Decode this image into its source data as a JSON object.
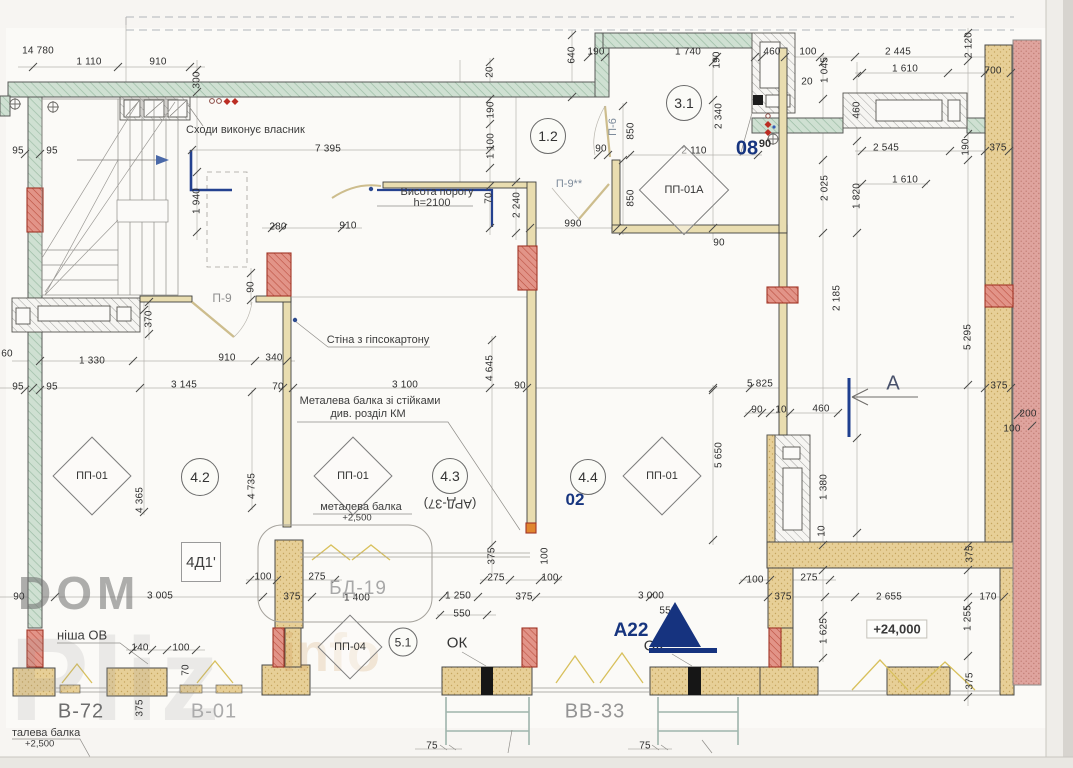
{
  "watermark": {
    "l1": "DOM",
    "l2": "Pliz",
    "l3": "info"
  },
  "rooms": [
    {
      "n": "1.2",
      "x": 548,
      "y": 136,
      "d": 34
    },
    {
      "n": "3.1",
      "x": 684,
      "y": 103,
      "d": 34
    },
    {
      "n": "4.2",
      "x": 200,
      "y": 477,
      "d": 36
    },
    {
      "n": "4.3",
      "x": 450,
      "y": 476,
      "d": 34
    },
    {
      "n": "4.4",
      "x": 588,
      "y": 477,
      "d": 34
    },
    {
      "n": "5.1",
      "x": 403,
      "y": 642,
      "d": 27
    }
  ],
  "panels": [
    {
      "n": "ПП-01",
      "x": 92,
      "y": 476,
      "s": 54
    },
    {
      "n": "ПП-01",
      "x": 353,
      "y": 476,
      "s": 54
    },
    {
      "n": "ПП-01",
      "x": 662,
      "y": 476,
      "s": 54
    },
    {
      "n": "ПП-01А",
      "x": 684,
      "y": 190,
      "s": 62
    },
    {
      "n": "ПП-04",
      "x": 350,
      "y": 647,
      "s": 44
    }
  ],
  "marks": {
    "m08": "08",
    "m08s": "90",
    "m02": "02",
    "a22": "А22",
    "secA": "А"
  },
  "doors": {
    "p9": "П-9",
    "p9s": "П-9**",
    "p6": "П-6"
  },
  "beams": {
    "bd19": "БД-19",
    "v72": "В-72",
    "v01": "В-01",
    "vv33": "ВВ-33",
    "ok1": "ОК",
    "ok2": "ОК",
    "ard": "(АРД-37)",
    "d41": "4Д1'",
    "lvl": "+24,000"
  },
  "annotations": {
    "stairs": "Сходи виконує власник",
    "vis1": "Висота порогу",
    "vis2": "h=2100",
    "wall": "Стіна з гіпсокартону",
    "mb1": "Металева балка зі стійками",
    "mb2": "див. розділ КМ",
    "mb3": "металева балка",
    "mb4": "+2,500",
    "tb1": "талева балка",
    "tb2": "+2,500",
    "nisha": "ніша ОВ"
  },
  "dims": [
    {
      "t": "14 780",
      "x": 38,
      "y": 51
    },
    {
      "t": "1 110",
      "x": 89,
      "y": 62
    },
    {
      "t": "910",
      "x": 158,
      "y": 62
    },
    {
      "t": "300",
      "x": 197,
      "y": 80,
      "r": 1
    },
    {
      "t": "7 395",
      "x": 328,
      "y": 149
    },
    {
      "t": "95",
      "x": 18,
      "y": 151
    },
    {
      "t": "95",
      "x": 52,
      "y": 151
    },
    {
      "t": "1 940",
      "x": 197,
      "y": 201,
      "r": 1
    },
    {
      "t": "280",
      "x": 278,
      "y": 227
    },
    {
      "t": "910",
      "x": 348,
      "y": 226
    },
    {
      "t": "90",
      "x": 251,
      "y": 287,
      "r": 1
    },
    {
      "t": "370",
      "x": 149,
      "y": 319,
      "r": 1
    },
    {
      "t": "60",
      "x": 7,
      "y": 354
    },
    {
      "t": "1 330",
      "x": 92,
      "y": 361
    },
    {
      "t": "910",
      "x": 227,
      "y": 358
    },
    {
      "t": "340",
      "x": 274,
      "y": 358
    },
    {
      "t": "95",
      "x": 18,
      "y": 387
    },
    {
      "t": "95",
      "x": 52,
      "y": 387
    },
    {
      "t": "3 145",
      "x": 184,
      "y": 385
    },
    {
      "t": "70",
      "x": 278,
      "y": 387
    },
    {
      "t": "4 365",
      "x": 140,
      "y": 500,
      "r": 1
    },
    {
      "t": "4 735",
      "x": 252,
      "y": 486,
      "r": 1
    },
    {
      "t": "3 100",
      "x": 405,
      "y": 385
    },
    {
      "t": "90",
      "x": 520,
      "y": 386
    },
    {
      "t": "4 645",
      "x": 490,
      "y": 368,
      "r": 1
    },
    {
      "t": "20",
      "x": 490,
      "y": 72,
      "r": 1
    },
    {
      "t": "190",
      "x": 491,
      "y": 110,
      "r": 1
    },
    {
      "t": "1 100",
      "x": 491,
      "y": 146,
      "r": 1
    },
    {
      "t": "70",
      "x": 489,
      "y": 198,
      "r": 1
    },
    {
      "t": "2 240",
      "x": 517,
      "y": 205,
      "r": 1
    },
    {
      "t": "640",
      "x": 572,
      "y": 55,
      "r": 1
    },
    {
      "t": "190",
      "x": 596,
      "y": 52
    },
    {
      "t": "1 740",
      "x": 688,
      "y": 52
    },
    {
      "t": "190",
      "x": 717,
      "y": 60,
      "r": 1
    },
    {
      "t": "90",
      "x": 601,
      "y": 149
    },
    {
      "t": "850",
      "x": 631,
      "y": 131,
      "r": 1
    },
    {
      "t": "850",
      "x": 631,
      "y": 198,
      "r": 1
    },
    {
      "t": "990",
      "x": 573,
      "y": 224
    },
    {
      "t": "2 110",
      "x": 694,
      "y": 151
    },
    {
      "t": "2 340",
      "x": 719,
      "y": 116,
      "r": 1
    },
    {
      "t": "90",
      "x": 719,
      "y": 243
    },
    {
      "t": "460",
      "x": 772,
      "y": 52
    },
    {
      "t": "100",
      "x": 808,
      "y": 52
    },
    {
      "t": "20",
      "x": 807,
      "y": 82
    },
    {
      "t": "1 045",
      "x": 825,
      "y": 70,
      "r": 1
    },
    {
      "t": "2 445",
      "x": 898,
      "y": 52
    },
    {
      "t": "1 610",
      "x": 905,
      "y": 69
    },
    {
      "t": "700",
      "x": 993,
      "y": 71
    },
    {
      "t": "2 120",
      "x": 969,
      "y": 45,
      "r": 1
    },
    {
      "t": "460",
      "x": 857,
      "y": 110,
      "r": 1
    },
    {
      "t": "2 545",
      "x": 886,
      "y": 148
    },
    {
      "t": "190",
      "x": 966,
      "y": 147,
      "r": 1
    },
    {
      "t": "375",
      "x": 998,
      "y": 148
    },
    {
      "t": "1 610",
      "x": 905,
      "y": 180
    },
    {
      "t": "2 025",
      "x": 825,
      "y": 188,
      "r": 1
    },
    {
      "t": "1 820",
      "x": 857,
      "y": 196,
      "r": 1
    },
    {
      "t": "2 185",
      "x": 837,
      "y": 298,
      "r": 1
    },
    {
      "t": "5 295",
      "x": 968,
      "y": 337,
      "r": 1
    },
    {
      "t": "375",
      "x": 999,
      "y": 386
    },
    {
      "t": "200",
      "x": 1028,
      "y": 414
    },
    {
      "t": "100",
      "x": 1012,
      "y": 429
    },
    {
      "t": "5 825",
      "x": 760,
      "y": 384
    },
    {
      "t": "90",
      "x": 757,
      "y": 410
    },
    {
      "t": "10",
      "x": 781,
      "y": 410
    },
    {
      "t": "460",
      "x": 821,
      "y": 409
    },
    {
      "t": "5 650",
      "x": 719,
      "y": 455,
      "r": 1
    },
    {
      "t": "1 380",
      "x": 824,
      "y": 487,
      "r": 1
    },
    {
      "t": "10",
      "x": 822,
      "y": 531,
      "r": 1
    },
    {
      "t": "375",
      "x": 970,
      "y": 554,
      "r": 1
    },
    {
      "t": "2 655",
      "x": 889,
      "y": 597
    },
    {
      "t": "170",
      "x": 988,
      "y": 597
    },
    {
      "t": "1 255",
      "x": 968,
      "y": 618,
      "r": 1
    },
    {
      "t": "1 625",
      "x": 824,
      "y": 631,
      "r": 1
    },
    {
      "t": "375",
      "x": 970,
      "y": 681,
      "r": 1
    },
    {
      "t": "90",
      "x": 19,
      "y": 597
    },
    {
      "t": "3 005",
      "x": 160,
      "y": 596
    },
    {
      "t": "100",
      "x": 263,
      "y": 577
    },
    {
      "t": "275",
      "x": 317,
      "y": 577
    },
    {
      "t": "375",
      "x": 292,
      "y": 597
    },
    {
      "t": "1 400",
      "x": 357,
      "y": 598
    },
    {
      "t": "140",
      "x": 140,
      "y": 648
    },
    {
      "t": "100",
      "x": 181,
      "y": 648
    },
    {
      "t": "70",
      "x": 186,
      "y": 670,
      "r": 1
    },
    {
      "t": "375",
      "x": 140,
      "y": 708,
      "r": 1
    },
    {
      "t": "1 250",
      "x": 458,
      "y": 596
    },
    {
      "t": "550",
      "x": 462,
      "y": 614
    },
    {
      "t": "375",
      "x": 492,
      "y": 556,
      "r": 1
    },
    {
      "t": "275",
      "x": 496,
      "y": 578
    },
    {
      "t": "100",
      "x": 545,
      "y": 556,
      "r": 1
    },
    {
      "t": "100",
      "x": 550,
      "y": 578
    },
    {
      "t": "375",
      "x": 524,
      "y": 597
    },
    {
      "t": "3 000",
      "x": 651,
      "y": 596
    },
    {
      "t": "550",
      "x": 668,
      "y": 611
    },
    {
      "t": "100",
      "x": 755,
      "y": 580
    },
    {
      "t": "275",
      "x": 809,
      "y": 578
    },
    {
      "t": "375",
      "x": 783,
      "y": 597
    },
    {
      "t": "75",
      "x": 432,
      "y": 746
    },
    {
      "t": "75",
      "x": 645,
      "y": 746
    }
  ]
}
